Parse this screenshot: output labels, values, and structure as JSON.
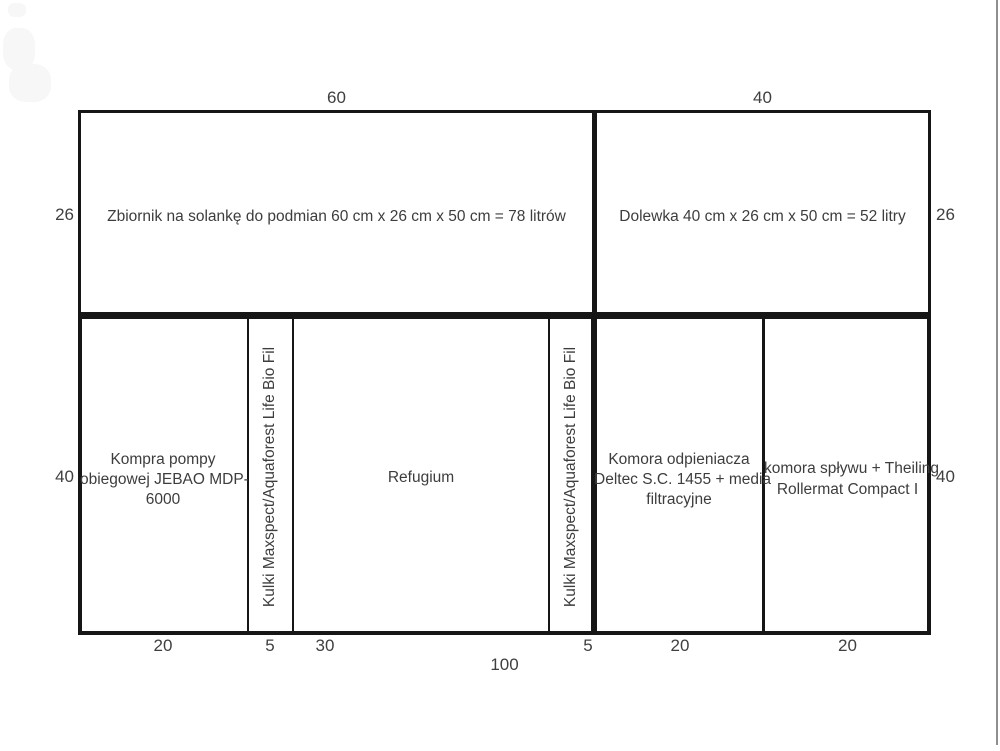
{
  "page": {
    "background": "#ffffff",
    "line_color": "#161616",
    "text_color": "#3d3d3d",
    "scrollbar_color": "#8f8f8f"
  },
  "top_row": {
    "width_label_left": "60",
    "width_label_right": "40",
    "brine_tank": {
      "label": "Zbiornik na solankę do podmian 60 cm x 26 cm x 50 cm = 78 litrów",
      "height_label": "26"
    },
    "top_off_tank": {
      "label": "Dolewka 40 cm x 26 cm x 50 cm = 52 litry",
      "height_label": "26"
    }
  },
  "sump_row": {
    "height_label_left": "40",
    "height_label_right": "40",
    "total_width_label": "100",
    "compartments": {
      "pump": {
        "lines": [
          "Kompra pompy",
          "obiegowej JEBAO MDP-",
          "6000"
        ],
        "width_label": "20"
      },
      "media_left": {
        "vertical_label": "Kulki Maxspect/Aquaforest Life Bio Fil",
        "width_label": "5"
      },
      "refugium": {
        "lines": [
          "Refugium"
        ],
        "width_label": "30"
      },
      "media_right": {
        "vertical_label": "Kulki Maxspect/Aquaforest Life Bio Fil",
        "width_label": "5"
      },
      "skimmer": {
        "lines": [
          "Komora odpieniacza",
          "Deltec S.C. 1455 + media",
          "filtracyjne"
        ],
        "width_label": "20"
      },
      "overflow": {
        "lines": [
          "komora spływu + Theiling",
          "Rollermat Compact I"
        ],
        "width_label": "20"
      }
    }
  }
}
